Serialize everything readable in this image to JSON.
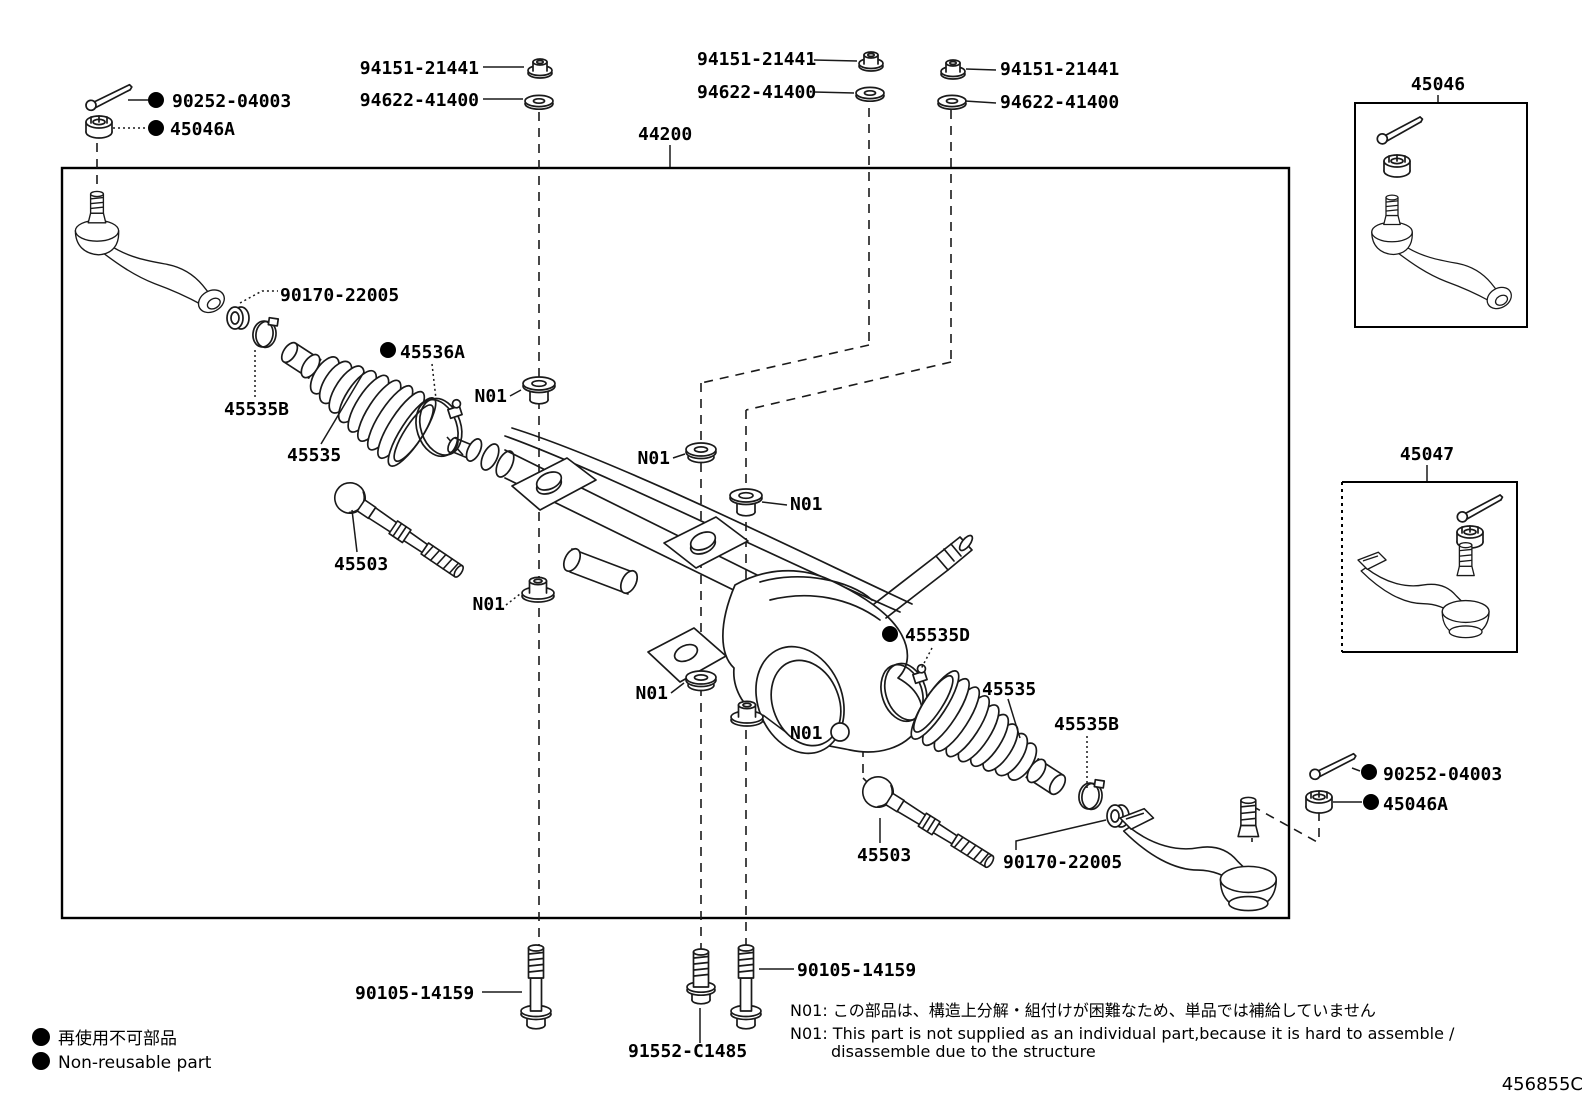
{
  "diagram": {
    "title_part_number": "44200",
    "icons": {
      "non_reusable_dot": "filled-circle"
    },
    "part_labels": [
      {
        "t": "94151-21441",
        "x": 479,
        "y": 74,
        "a": "end",
        "name": "label-nut-94151-left"
      },
      {
        "t": "94622-41400",
        "x": 479,
        "y": 106,
        "a": "end",
        "name": "label-washer-94622-left"
      },
      {
        "t": "90252-04003",
        "x": 172,
        "y": 107,
        "a": "start",
        "dot": [
          156,
          100,
          8
        ],
        "name": "label-cotter-90252-topleft"
      },
      {
        "t": "45046A",
        "x": 170,
        "y": 135,
        "a": "start",
        "dot": [
          156,
          128,
          8
        ],
        "name": "label-nut-45046A-topleft"
      },
      {
        "t": "94151-21441",
        "x": 697,
        "y": 65,
        "a": "start",
        "name": "label-nut-94151-mid"
      },
      {
        "t": "94622-41400",
        "x": 697,
        "y": 98,
        "a": "start",
        "name": "label-washer-94622-mid"
      },
      {
        "t": "94151-21441",
        "x": 1000,
        "y": 75,
        "a": "start",
        "name": "label-nut-94151-right"
      },
      {
        "t": "94622-41400",
        "x": 1000,
        "y": 108,
        "a": "start",
        "name": "label-washer-94622-right"
      },
      {
        "t": "44200",
        "x": 638,
        "y": 140,
        "a": "start",
        "name": "label-rack-44200"
      },
      {
        "t": "45046",
        "x": 1438,
        "y": 90,
        "a": "middle",
        "name": "label-inset-45046"
      },
      {
        "t": "45047",
        "x": 1427,
        "y": 460,
        "a": "middle",
        "name": "label-inset-45047"
      },
      {
        "t": "90170-22005",
        "x": 280,
        "y": 301,
        "a": "start",
        "name": "label-collar-left"
      },
      {
        "t": "45536A",
        "x": 400,
        "y": 358,
        "a": "start",
        "dot": [
          388,
          350,
          8
        ],
        "name": "label-clamp-45536A"
      },
      {
        "t": "45535B",
        "x": 224,
        "y": 415,
        "a": "start",
        "name": "label-clamp-45535B-left"
      },
      {
        "t": "45535",
        "x": 287,
        "y": 461,
        "a": "start",
        "name": "label-boot-45535-left"
      },
      {
        "t": "45503",
        "x": 334,
        "y": 570,
        "a": "start",
        "name": "label-innerrod-45503-left"
      },
      {
        "t": "N01",
        "x": 507,
        "y": 402,
        "a": "end",
        "name": "label-n01-1"
      },
      {
        "t": "N01",
        "x": 670,
        "y": 464,
        "a": "end",
        "name": "label-n01-2"
      },
      {
        "t": "N01",
        "x": 790,
        "y": 510,
        "a": "start",
        "name": "label-n01-3"
      },
      {
        "t": "N01",
        "x": 505,
        "y": 610,
        "a": "end",
        "name": "label-n01-4"
      },
      {
        "t": "N01",
        "x": 668,
        "y": 699,
        "a": "end",
        "name": "label-n01-5"
      },
      {
        "t": "N01",
        "x": 790,
        "y": 739,
        "a": "start",
        "name": "label-n01-6"
      },
      {
        "t": "45535D",
        "x": 905,
        "y": 641,
        "a": "start",
        "dot": [
          890,
          634,
          8
        ],
        "name": "label-clamp-45535D"
      },
      {
        "t": "45535",
        "x": 982,
        "y": 695,
        "a": "start",
        "name": "label-boot-45535-right"
      },
      {
        "t": "45535B",
        "x": 1054,
        "y": 730,
        "a": "start",
        "name": "label-clamp-45535B-right"
      },
      {
        "t": "45503",
        "x": 857,
        "y": 861,
        "a": "start",
        "name": "label-innerrod-45503-right"
      },
      {
        "t": "90170-22005",
        "x": 1003,
        "y": 868,
        "a": "start",
        "name": "label-collar-right"
      },
      {
        "t": "90252-04003",
        "x": 1383,
        "y": 780,
        "a": "start",
        "dot": [
          1369,
          772,
          8
        ],
        "name": "label-cotter-90252-botright"
      },
      {
        "t": "45046A",
        "x": 1383,
        "y": 810,
        "a": "start",
        "dot": [
          1371,
          802,
          8
        ],
        "name": "label-nut-45046A-botright"
      },
      {
        "t": "90105-14159",
        "x": 355,
        "y": 999,
        "a": "start",
        "name": "label-bolt-90105-left"
      },
      {
        "t": "90105-14159",
        "x": 797,
        "y": 976,
        "a": "start",
        "name": "label-bolt-90105-right"
      },
      {
        "t": "91552-C1485",
        "x": 628,
        "y": 1057,
        "a": "start",
        "name": "label-bolt-91552"
      }
    ],
    "notes": [
      {
        "t": "N01: この部品は、構造上分解・組付けが困難なため、単品では補給していません",
        "x": 790,
        "y": 1016,
        "a": "start",
        "cls": "note",
        "name": "note-n01-japanese"
      },
      {
        "t": "N01: This part is not supplied as an individual part,because it is hard to assemble /",
        "x": 790,
        "y": 1039,
        "a": "start",
        "cls": "note",
        "name": "note-n01-english-line1"
      },
      {
        "t": "disassemble due to the structure",
        "x": 831,
        "y": 1057,
        "a": "start",
        "cls": "note",
        "name": "note-n01-english-line2"
      }
    ],
    "legend": [
      {
        "t": "再使用不可部品",
        "x": 58,
        "y": 1044,
        "a": "start",
        "cls": "legend",
        "dot": [
          41,
          1037,
          9
        ],
        "name": "legend-non-reusable-jp"
      },
      {
        "t": "Non-reusable part",
        "x": 58,
        "y": 1068,
        "a": "start",
        "cls": "legend",
        "dot": [
          41,
          1061,
          9
        ],
        "name": "legend-non-reusable-en"
      }
    ],
    "code": {
      "t": "456855C",
      "x": 1583,
      "y": 1090,
      "a": "end",
      "cls": "code",
      "name": "drawing-code"
    }
  }
}
